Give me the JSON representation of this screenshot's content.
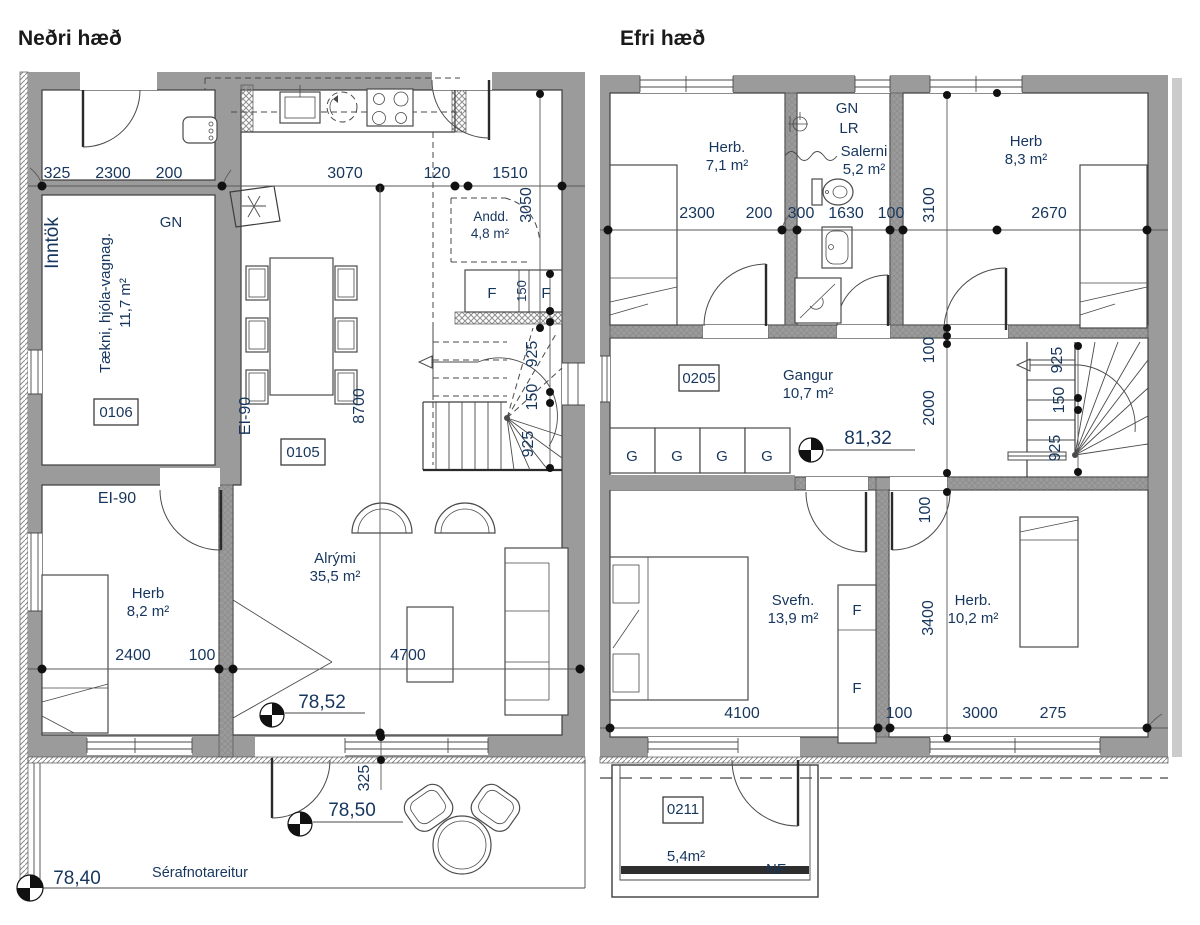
{
  "colors": {
    "wall": "#9b9b9b",
    "text": "#17365d",
    "line": "#3d3d3d",
    "neighbor": "#cbcbcb"
  },
  "lower": {
    "title": "Neðri hæð",
    "dims": {
      "w325": "325",
      "w2300": "2300",
      "w200": "200",
      "w3070": "3070",
      "w120": "120",
      "w1510": "1510",
      "h3050": "3050",
      "h8700": "8700",
      "f150": "150",
      "s925a": "925",
      "s150": "150",
      "s925b": "925",
      "b2400": "2400",
      "b100": "100",
      "b4700": "4700",
      "v325": "325"
    },
    "labels": {
      "inntok": "Inntök",
      "gn": "GN",
      "taekni": "Tækni, hjóla-vagnag.",
      "taekni_area": "11,7 m²",
      "code_0106": "0106",
      "ei90_vert": "EI-90",
      "code_0105": "0105",
      "ei90_horiz": "EI-90",
      "andd": "Andd.",
      "andd_area": "4,8 m²",
      "f_left": "F",
      "f_right": "F",
      "herb": "Herb",
      "herb_area": "8,2 m²",
      "alrymi": "Alrými",
      "alrymi_area": "35,5 m²",
      "serafnot": "Sérafnotareitur"
    },
    "levels": {
      "l1": "78,52",
      "l2": "78,50",
      "l3": "78,40"
    }
  },
  "upper": {
    "title": "Efri hæð",
    "dims": {
      "t2300": "2300",
      "t200": "200",
      "t300": "300",
      "t1630": "1630",
      "t100": "100",
      "h3100": "3100",
      "t2670": "2670",
      "h100a": "100",
      "h2000": "2000",
      "s925a": "925",
      "s150": "150",
      "s925b": "925",
      "h100b": "100",
      "h3400": "3400",
      "b4100": "4100",
      "b100": "100",
      "b3000": "3000",
      "b275": "275"
    },
    "labels": {
      "herb71": "Herb.",
      "herb71_area": "7,1 m²",
      "gn": "GN",
      "lr": "LR",
      "salerni": "Salerni",
      "salerni_area": "5,2 m²",
      "herb83": "Herb",
      "herb83_area": "8,3 m²",
      "code_0205": "0205",
      "gangur": "Gangur",
      "gangur_area": "10,7 m²",
      "g1": "G",
      "g2": "G",
      "g3": "G",
      "g4": "G",
      "svefn": "Svefn.",
      "svefn_area": "13,9 m²",
      "f_top": "F",
      "f_bottom": "F",
      "herb102": "Herb.",
      "herb102_area": "10,2 m²",
      "code_0211": "0211",
      "balcony_area": "5,4m²",
      "nf": "NF"
    },
    "levels": {
      "l1": "81,32"
    }
  }
}
